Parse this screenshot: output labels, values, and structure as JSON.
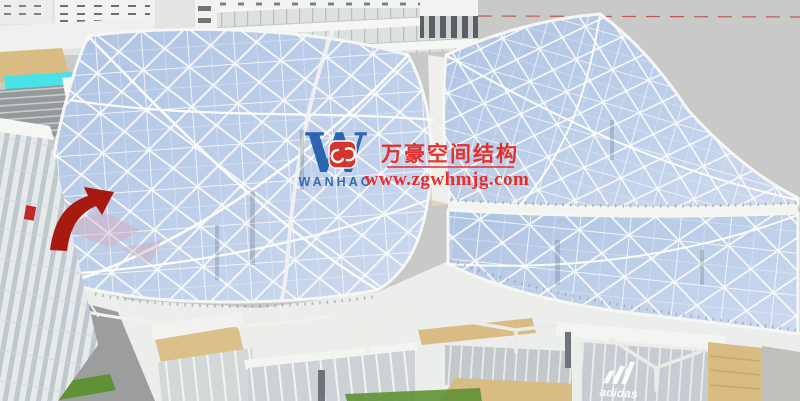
{
  "scene": {
    "description": "3D architectural rendering of a curved triangulated glass space-frame canopy over a shopping mall",
    "watermark": {
      "logo_letter": "W",
      "logo_text": "WANHAO",
      "company_name": "万豪空间结构",
      "website": "www.zgwhmjg.com"
    },
    "signs": {
      "storefront_brand": "adidas"
    },
    "colors": {
      "sky": "#c9c9c7",
      "canopy_glass": "#aec4e4",
      "canopy_glass_light": "#cdd9ef",
      "frame_white": "#f6f6f4",
      "watermark_red": "#e8211a",
      "logo_blue": "#1e5cab",
      "emblem_red": "#d5281c",
      "awning_red": "#a81a10",
      "wood": "#d9bc84",
      "grass": "#5f9136",
      "skybridge_cyan": "#49e2e6"
    }
  }
}
